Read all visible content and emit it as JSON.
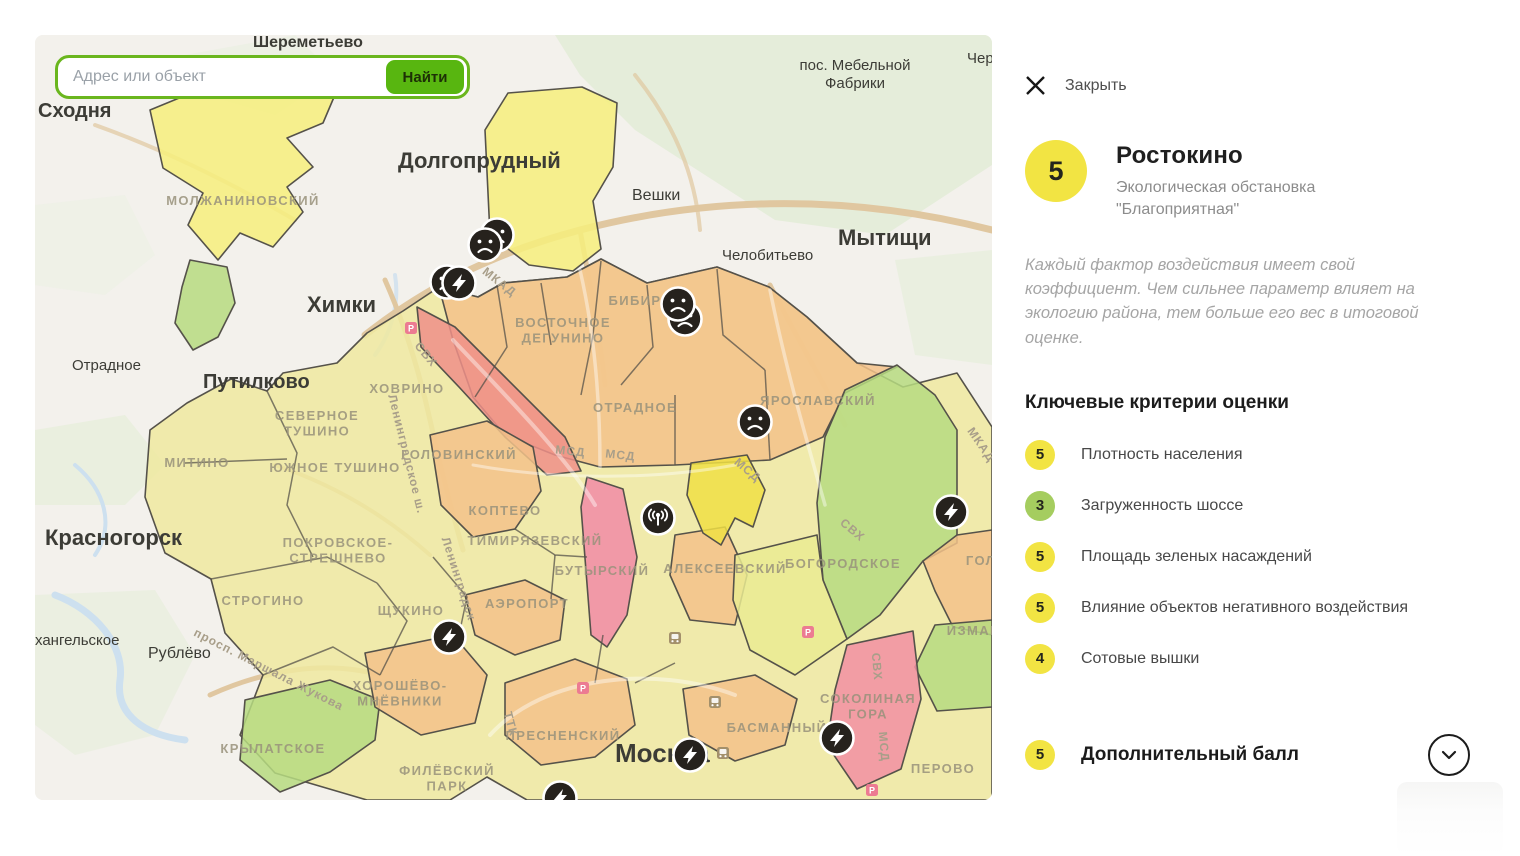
{
  "palette": {
    "accent_green": "#6ab61e",
    "score_yellow": "#f2e443",
    "score_green": "#a5cd5f"
  },
  "search": {
    "placeholder": "Адрес или объект",
    "button_label": "Найти"
  },
  "panel": {
    "close_label": "Закрыть",
    "district": {
      "score": "5",
      "name": "Ростокино",
      "subtitle": "Экологическая обстановка \"Благоприятная\""
    },
    "note": "Каждый фактор воздействия имеет свой коэффициент. Чем сильнее параметр влияет на экологию района, тем больше его вес в итоговой оценке.",
    "criteria_heading": "Ключевые критерии оценки",
    "criteria": [
      {
        "score": "5",
        "label": "Плотность населения",
        "color": "#f2e443"
      },
      {
        "score": "3",
        "label": "Загруженность шоссе",
        "color": "#a5cd5f"
      },
      {
        "score": "5",
        "label": "Площадь зеленых насаждений",
        "color": "#f2e443"
      },
      {
        "score": "5",
        "label": "Влияние объектов негативного воздействия",
        "color": "#f2e443"
      },
      {
        "score": "4",
        "label": "Сотовые вышки",
        "color": "#f2e443"
      }
    ],
    "extra": {
      "score": "5",
      "label": "Дополнительный балл"
    }
  },
  "map": {
    "city_labels": [
      {
        "text": "Шереметьево",
        "x": 218,
        "y": 12,
        "size": 16,
        "w": 600
      },
      {
        "text": "Сходня",
        "x": 3,
        "y": 82,
        "size": 20,
        "w": 600
      },
      {
        "text": "Долгопрудный",
        "x": 363,
        "y": 133,
        "size": 22,
        "w": 700
      },
      {
        "text": "Вешки",
        "x": 597,
        "y": 165,
        "size": 16,
        "w": 500
      },
      {
        "text": "Мытищи",
        "x": 803,
        "y": 210,
        "size": 22,
        "w": 700
      },
      {
        "lines": [
          "пос. Мебельной",
          "Фабрики"
        ],
        "x": 820,
        "y": 35,
        "size": 15,
        "w": 500,
        "anchor": "middle"
      },
      {
        "text": "Чер",
        "x": 932,
        "y": 28,
        "size": 15,
        "w": 500
      },
      {
        "text": "Челобитьево",
        "x": 687,
        "y": 225,
        "size": 15,
        "w": 500
      },
      {
        "text": "Химки",
        "x": 272,
        "y": 277,
        "size": 22,
        "w": 700
      },
      {
        "text": "Путилково",
        "x": 168,
        "y": 353,
        "size": 20,
        "w": 600
      },
      {
        "text": "Отрадное",
        "x": 37,
        "y": 335,
        "size": 15,
        "w": 500
      },
      {
        "text": "Красногорск",
        "x": 10,
        "y": 510,
        "size": 22,
        "w": 700
      },
      {
        "text": "Рублёво",
        "x": 113,
        "y": 623,
        "size": 16,
        "w": 500
      },
      {
        "text": "хангельское",
        "x": 0,
        "y": 610,
        "size": 15,
        "w": 500
      },
      {
        "text": "Москва",
        "x": 580,
        "y": 727,
        "size": 26,
        "w": 700,
        "color": "#4a4336"
      }
    ],
    "district_labels": [
      {
        "text": "МОЛЖАНИНОВСКИЙ",
        "x": 208,
        "y": 170
      },
      {
        "text": "ХОВРИНО",
        "x": 372,
        "y": 358
      },
      {
        "lines": [
          "ВОСТОЧНОЕ",
          "ДЕГУНИНО"
        ],
        "x": 528,
        "y": 292
      },
      {
        "text": "БИБИРЕВО",
        "x": 616,
        "y": 270
      },
      {
        "lines": [
          "СЕВЕРНОЕ",
          "ТУШИНО"
        ],
        "x": 282,
        "y": 385
      },
      {
        "text": "ЮЖНОЕ ТУШИНО",
        "x": 300,
        "y": 437
      },
      {
        "text": "МИТИНО",
        "x": 162,
        "y": 432
      },
      {
        "text": "ГОЛОВИНСКИЙ",
        "x": 424,
        "y": 424
      },
      {
        "text": "ОТРАДНОЕ",
        "x": 600,
        "y": 377
      },
      {
        "text": "ЯРОСЛАВСКИЙ",
        "x": 783,
        "y": 370
      },
      {
        "lines": [
          "ПОКРОВСКОЕ-",
          "СТРЕШНЕВО"
        ],
        "x": 303,
        "y": 512
      },
      {
        "text": "КОПТЕВО",
        "x": 470,
        "y": 480
      },
      {
        "text": "ТИМИРЯЗЕВСКИЙ",
        "x": 500,
        "y": 510
      },
      {
        "text": "БУТЫРСКИЙ",
        "x": 567,
        "y": 540
      },
      {
        "text": "АЛЕКСЕЕВСКИЙ",
        "x": 690,
        "y": 538
      },
      {
        "text": "БОГОРОДСКОЕ",
        "x": 808,
        "y": 533
      },
      {
        "text": "ГОЛ",
        "x": 946,
        "y": 530
      },
      {
        "text": "СТРОГИНО",
        "x": 228,
        "y": 570
      },
      {
        "text": "ЩУКИНО",
        "x": 376,
        "y": 580
      },
      {
        "text": "АЭРОПОРТ",
        "x": 492,
        "y": 573
      },
      {
        "lines": [
          "ХОРОШЁВО-",
          "МНЁВНИКИ"
        ],
        "x": 365,
        "y": 655
      },
      {
        "text": "КРЫЛАТСКОЕ",
        "x": 238,
        "y": 718
      },
      {
        "lines": [
          "ФИЛЁВСКИЙ",
          "ПАРК"
        ],
        "x": 412,
        "y": 740
      },
      {
        "text": "ПРЕСНЕНСКИЙ",
        "x": 528,
        "y": 705
      },
      {
        "text": "БАСМАННЫЙ",
        "x": 742,
        "y": 697
      },
      {
        "lines": [
          "СОКОЛИНАЯ",
          "ГОРА"
        ],
        "x": 833,
        "y": 668
      },
      {
        "text": "ПЕРОВО",
        "x": 908,
        "y": 738
      },
      {
        "text": "ИЗМАЙЛ",
        "x": 944,
        "y": 600
      }
    ],
    "road_labels": [
      {
        "text": "МКАД",
        "x": 462,
        "y": 250,
        "r": 38
      },
      {
        "text": "МКАД",
        "x": 943,
        "y": 412,
        "r": 55
      },
      {
        "text": "МСД",
        "x": 535,
        "y": 420,
        "r": 6
      },
      {
        "text": "МСД",
        "x": 585,
        "y": 424,
        "r": 6
      },
      {
        "text": "МСД",
        "x": 710,
        "y": 438,
        "r": 40
      },
      {
        "text": "СВХ",
        "x": 815,
        "y": 498,
        "r": 40
      },
      {
        "text": "СВХ",
        "x": 388,
        "y": 322,
        "r": 50
      },
      {
        "text": "Ленинградское ш.",
        "x": 368,
        "y": 420,
        "r": 76
      },
      {
        "text": "Ленинградск",
        "x": 420,
        "y": 545,
        "r": 72
      },
      {
        "text": "просп. Маршала Жукова",
        "x": 232,
        "y": 638,
        "r": 27
      },
      {
        "text": "ТТК",
        "x": 472,
        "y": 690,
        "r": 75
      },
      {
        "text": "СВХ",
        "x": 838,
        "y": 632,
        "r": 85
      },
      {
        "text": "МСД",
        "x": 845,
        "y": 712,
        "r": 85
      }
    ],
    "markers": [
      {
        "type": "parking",
        "x": 376,
        "y": 293
      },
      {
        "type": "train",
        "x": 640,
        "y": 603
      },
      {
        "type": "train",
        "x": 680,
        "y": 667
      },
      {
        "type": "train",
        "x": 688,
        "y": 718
      },
      {
        "type": "parking",
        "x": 773,
        "y": 597
      },
      {
        "type": "parking",
        "x": 837,
        "y": 755
      },
      {
        "type": "parking",
        "x": 548,
        "y": 653
      },
      {
        "type": "sad",
        "x": 462,
        "y": 200
      },
      {
        "type": "sad",
        "x": 450,
        "y": 210
      },
      {
        "type": "sad",
        "x": 412,
        "y": 247
      },
      {
        "type": "bolt",
        "x": 424,
        "y": 248
      },
      {
        "type": "sad",
        "x": 650,
        "y": 284
      },
      {
        "type": "sad",
        "x": 643,
        "y": 269
      },
      {
        "type": "sad",
        "x": 720,
        "y": 387
      },
      {
        "type": "tower",
        "x": 623,
        "y": 483
      },
      {
        "type": "bolt",
        "x": 916,
        "y": 477
      },
      {
        "type": "bolt",
        "x": 414,
        "y": 602
      },
      {
        "type": "bolt",
        "x": 802,
        "y": 703
      },
      {
        "type": "bolt",
        "x": 655,
        "y": 720
      },
      {
        "type": "bolt",
        "x": 525,
        "y": 763
      }
    ]
  }
}
